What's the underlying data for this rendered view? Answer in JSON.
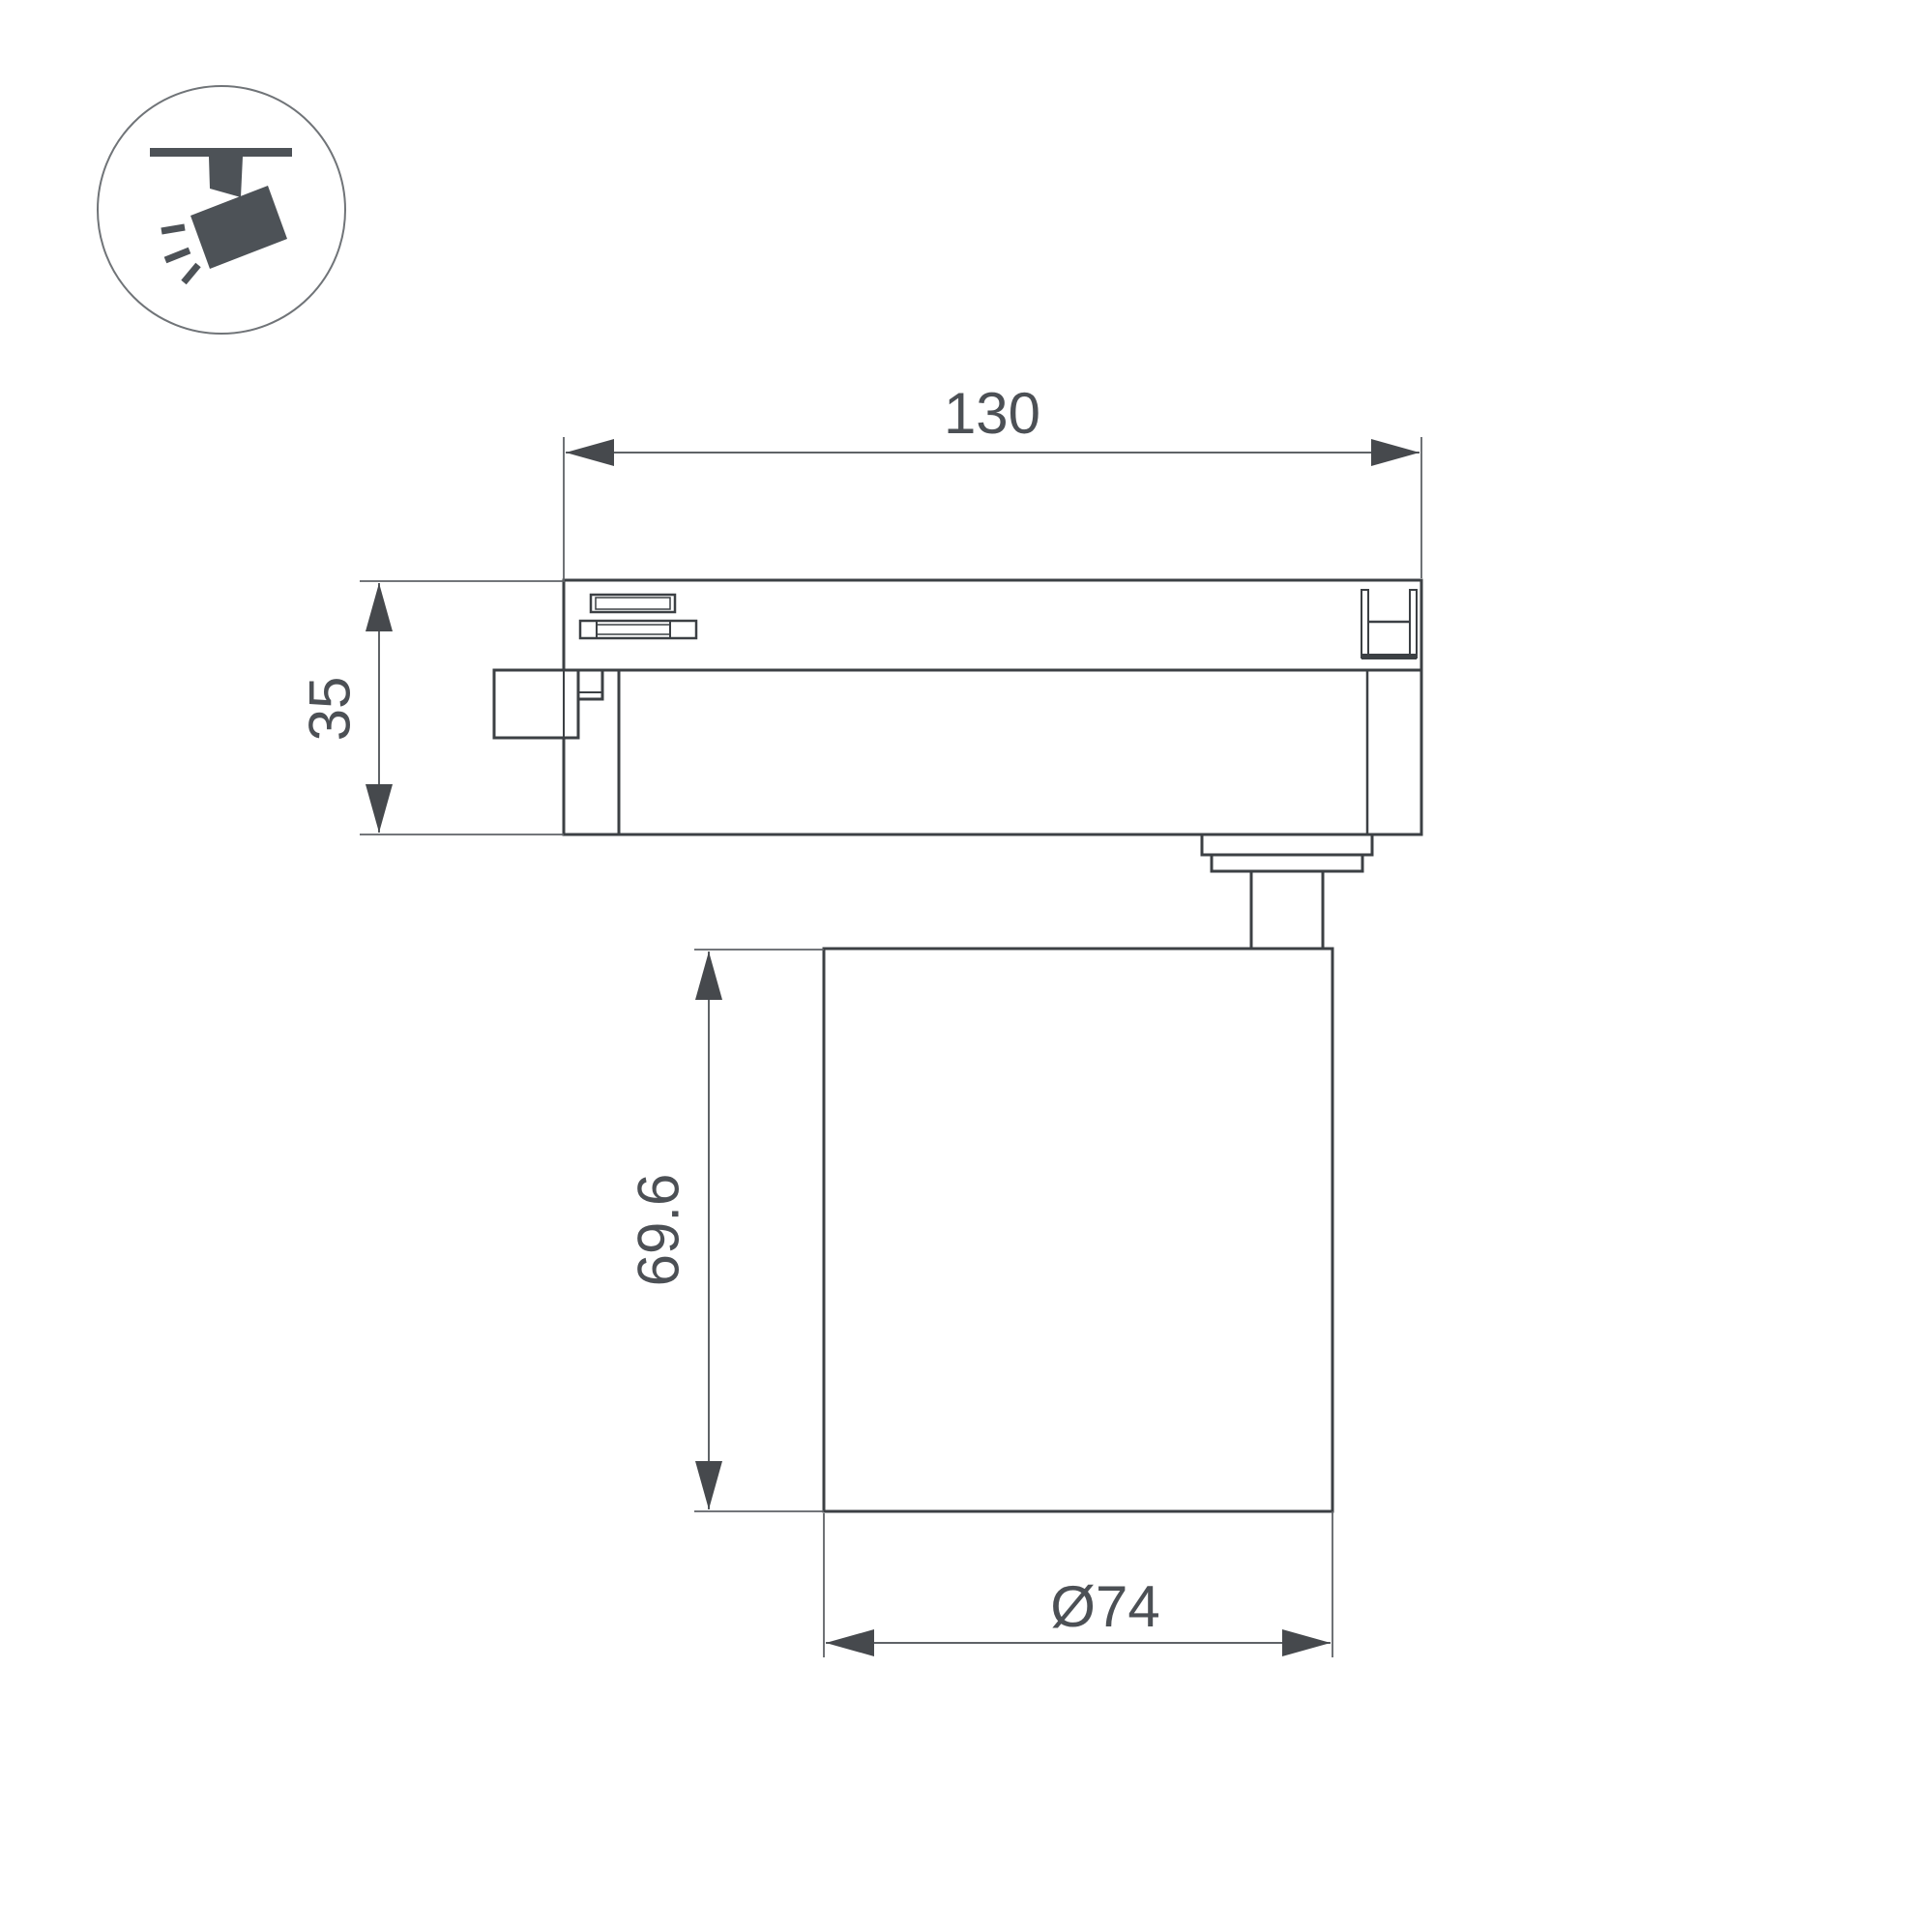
{
  "icon": {
    "name": "track-spotlight-icon"
  },
  "dimensions": {
    "track_length": "130",
    "track_height": "35",
    "body_height": "69.6",
    "body_diameter": "Ø74"
  },
  "colors": {
    "outline": "#3c4044",
    "dimension_line": "#5f6367",
    "arrow_fill": "#46494d",
    "text": "#4c5055",
    "icon_fill": "#4d5257",
    "icon_circle_stroke": "#707478",
    "background": "#ffffff"
  }
}
